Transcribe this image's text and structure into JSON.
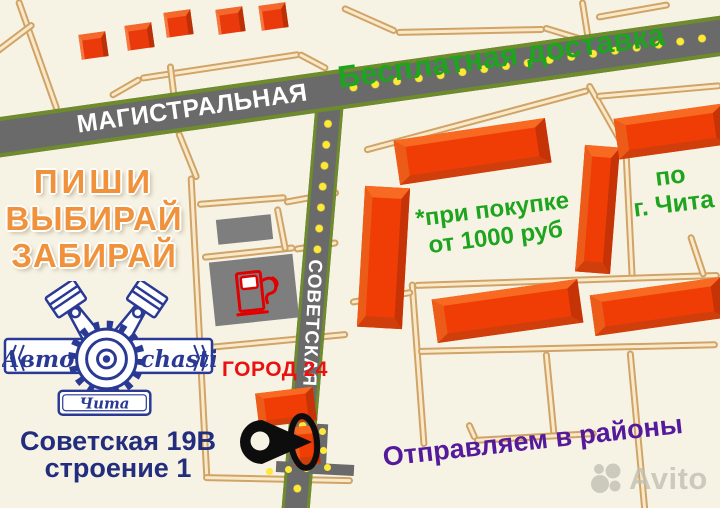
{
  "map": {
    "streets": {
      "magistralnaya": "МАГИСТРАЛЬНАЯ",
      "sovetskaya": "СОВЕТСКАЯ"
    },
    "promo": {
      "free_delivery": "Бесплатная доставка",
      "condition_line1": "*при покупке",
      "condition_line2": "от 1000 руб",
      "area_line1": "по",
      "area_line2": "г. Чита",
      "districts": "Отправляем в районы"
    },
    "slogan": {
      "line1": "ПИШИ",
      "line2": "ВЫБИРАЙ",
      "line3": "ЗАБИРАЙ"
    },
    "store_label": "ГОРОД 24",
    "address": {
      "line1": "Советская 19В",
      "line2": "строение 1"
    },
    "logo": {
      "left_text": "Авто",
      "right_text": "chasti",
      "city_banner": "Чита"
    },
    "watermark": "Avito",
    "icons": [
      "gas-pump-icon",
      "location-pin-icon",
      "piston-gear-logo-icon",
      "avito-logo-icon"
    ],
    "colors": {
      "background": "#f7f3e4",
      "road_fill": "#6a6a6a",
      "road_edge": "#6f8c2c",
      "road_dots": "#ffe937",
      "minor_road": "#fae9c9",
      "minor_road_edge": "#d0a468",
      "building_orange": "#f03d06",
      "building_gray": "#7e7e7e",
      "slogan_orange": "#f0923b",
      "delivery_green": "#1ea41e",
      "store_red": "#ea1111",
      "address_navy": "#232d7e",
      "logo_navy": "#2a3a94",
      "districts_purple": "#551a9b",
      "street_label_white": "#ffffff",
      "watermark_gray": "#c2c0b4",
      "pin_black": "#0d0d0d",
      "pump_red": "#e00000"
    }
  }
}
